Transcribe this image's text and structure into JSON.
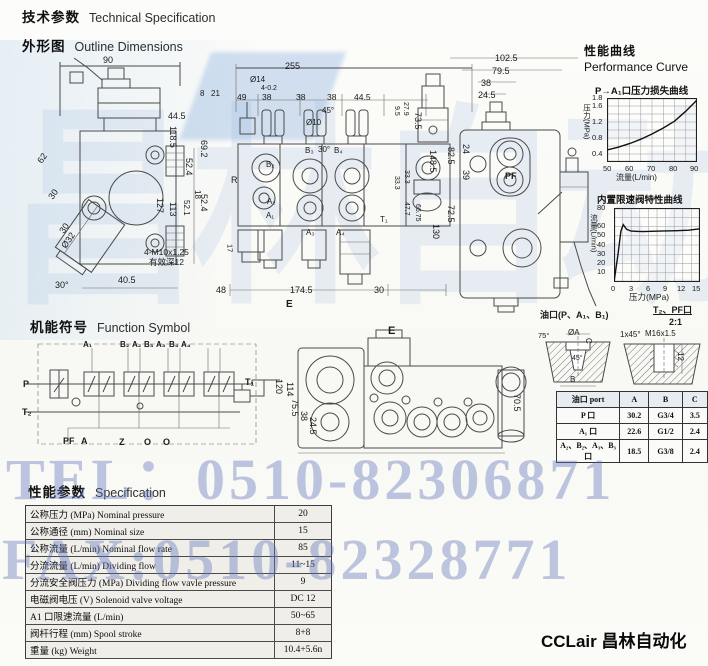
{
  "page": {
    "header_cn": "技术参数",
    "header_en": "Technical Specification",
    "outline_cn": "外形图",
    "outline_en": "Outline Dimensions",
    "function_cn": "机能符号",
    "function_en": "Function Symbol",
    "spec_cn": "性能参数",
    "spec_en": "Specification",
    "perf_cn": "性能曲线",
    "perf_en": "Performance Curve",
    "brand": "CCLair 昌林自动化"
  },
  "watermarks": {
    "tel": "TEL：0510-82306871",
    "fax": "FAX:0510-82328771",
    "big": "昌林自动化"
  },
  "colors": {
    "watermark_blue": "#5f73bc",
    "scan_tint": "#aacdeb",
    "line": "#4a4a4a",
    "table_row_bg": "#efeee9"
  },
  "chart_data": [
    {
      "type": "line",
      "title": "P→A₁口压力损失曲线",
      "xlabel": "流量(L/min)",
      "ylabel": "压力(MPa)",
      "x": [
        50,
        55,
        60,
        65,
        70,
        75,
        80,
        85,
        90
      ],
      "y": [
        0.5,
        0.57,
        0.66,
        0.77,
        0.9,
        1.05,
        1.22,
        1.47,
        1.75
      ],
      "xlim": [
        50,
        90
      ],
      "ylim": [
        0.2,
        1.8
      ],
      "xticks": [
        50,
        60,
        70,
        80,
        90
      ],
      "yticks": [
        0.4,
        0.8,
        1.2,
        1.6,
        1.8
      ],
      "grid_cols": 8,
      "grid_rows": 8,
      "grid": true,
      "legend": false
    },
    {
      "type": "line",
      "title": "内置限速阀特性曲线",
      "xlabel": "压力(MPa)",
      "ylabel": "流量(L/min)",
      "x": [
        0,
        0.7,
        1.2,
        1.6,
        2.2,
        3,
        5,
        8,
        11,
        13,
        15
      ],
      "y": [
        0,
        30,
        55,
        62,
        57,
        55,
        54.5,
        55,
        55.5,
        56,
        57.5
      ],
      "xlim": [
        0,
        15
      ],
      "ylim": [
        0,
        80
      ],
      "xticks": [
        0,
        3,
        6,
        9,
        12,
        15
      ],
      "yticks": [
        10,
        20,
        30,
        40,
        50,
        60,
        80
      ],
      "grid_cols": 10,
      "grid_rows": 8,
      "grid": true,
      "legend": false
    }
  ],
  "port_table": {
    "rows": [
      [
        "油口 port",
        "A",
        "B",
        "C"
      ],
      [
        "P 口",
        "30.2",
        "G3/4",
        "3.5"
      ],
      [
        "A₁ 口",
        "22.6",
        "G1/2",
        "2.4"
      ],
      [
        "A₂、B₂、A₃、B₃ 口",
        "18.5",
        "G3/8",
        "2.4"
      ]
    ]
  },
  "spec_table": {
    "rows": [
      [
        "公称压力 (MPa)  Nominal pressure",
        "20"
      ],
      [
        "公称通径 (mm)  Nominal size",
        "15"
      ],
      [
        "公称流量 (L/min)  Nominal flow rate",
        "85"
      ],
      [
        "分流流量 (L/min)  Dividing flow",
        "11~15"
      ],
      [
        "分流安全阀压力 (MPa)  Dividing flow vavle pressure",
        "9"
      ],
      [
        "电磁阀电压 (V)  Solenoid valve voltage",
        "DC 12"
      ],
      [
        "A1 口限速流量 (L/min)",
        "50~65"
      ],
      [
        "阀杆行程 (mm)  Spool stroke",
        "8+8"
      ],
      [
        "重量 (kg)  Weight",
        "10.4+5.6n"
      ]
    ]
  },
  "labels": [
    {
      "t": "90",
      "x": 103,
      "y": 56
    },
    {
      "t": "44.5",
      "x": 168,
      "y": 112
    },
    {
      "t": "69.2",
      "x": 199,
      "y": 140,
      "v": 1
    },
    {
      "t": "52.4",
      "x": 199,
      "y": 194,
      "v": 1
    },
    {
      "t": "62",
      "x": 36,
      "y": 160,
      "r": -55
    },
    {
      "t": "30",
      "x": 47,
      "y": 196,
      "r": -55
    },
    {
      "t": "30",
      "x": 58,
      "y": 230,
      "r": -55
    },
    {
      "t": "Ø32",
      "x": 60,
      "y": 245,
      "r": -55
    },
    {
      "t": "30°",
      "x": 55,
      "y": 281
    },
    {
      "t": "40.5",
      "x": 118,
      "y": 276
    },
    {
      "t": "8",
      "x": 200,
      "y": 90,
      "s": 8
    },
    {
      "t": "21",
      "x": 211,
      "y": 90,
      "s": 8
    },
    {
      "t": "118.5",
      "x": 168,
      "y": 126,
      "v": 1
    },
    {
      "t": "52.4",
      "x": 184,
      "y": 158,
      "v": 1
    },
    {
      "t": "18",
      "x": 193,
      "y": 190,
      "v": 1,
      "s": 8
    },
    {
      "t": "52.1",
      "x": 182,
      "y": 200,
      "v": 1,
      "s": 8
    },
    {
      "t": "127",
      "x": 155,
      "y": 198,
      "v": 1
    },
    {
      "t": "113",
      "x": 168,
      "y": 202,
      "v": 1
    },
    {
      "t": "17",
      "x": 226,
      "y": 244,
      "v": 1,
      "s": 7.5
    },
    {
      "t": "4-M10x1.25",
      "x": 144,
      "y": 248,
      "s": 8.5
    },
    {
      "t": "有效深12",
      "x": 149,
      "y": 258,
      "s": 8.5
    },
    {
      "t": "255",
      "x": 285,
      "y": 62
    },
    {
      "t": "Ø14",
      "x": 250,
      "y": 76,
      "s": 8
    },
    {
      "t": "4-0.2",
      "x": 261,
      "y": 85,
      "s": 7
    },
    {
      "t": "49",
      "x": 237,
      "y": 93,
      "s": 8.5
    },
    {
      "t": "38",
      "x": 262,
      "y": 93,
      "s": 8.5
    },
    {
      "t": "38",
      "x": 296,
      "y": 93,
      "s": 8.5
    },
    {
      "t": "38",
      "x": 327,
      "y": 93,
      "s": 8.5
    },
    {
      "t": "44.5",
      "x": 354,
      "y": 93,
      "s": 8.5
    },
    {
      "t": "45°",
      "x": 322,
      "y": 107,
      "s": 8
    },
    {
      "t": "Ø10",
      "x": 306,
      "y": 119,
      "s": 8
    },
    {
      "t": "30°",
      "x": 318,
      "y": 146,
      "s": 8
    },
    {
      "t": "R",
      "x": 231,
      "y": 176
    },
    {
      "t": "B₂",
      "x": 266,
      "y": 161,
      "s": 8
    },
    {
      "t": "B₃",
      "x": 305,
      "y": 147,
      "s": 8
    },
    {
      "t": "B₄",
      "x": 334,
      "y": 147,
      "s": 8
    },
    {
      "t": "A₂",
      "x": 267,
      "y": 198,
      "s": 8
    },
    {
      "t": "A₁",
      "x": 266,
      "y": 212,
      "s": 8
    },
    {
      "t": "A₃",
      "x": 306,
      "y": 229,
      "s": 8
    },
    {
      "t": "A₄",
      "x": 336,
      "y": 229,
      "s": 8
    },
    {
      "t": "T₁",
      "x": 380,
      "y": 216,
      "s": 8
    },
    {
      "t": "9.5",
      "x": 393,
      "y": 106,
      "v": 1,
      "s": 7
    },
    {
      "t": "27.9",
      "x": 402,
      "y": 102,
      "v": 1,
      "s": 7
    },
    {
      "t": "73.5",
      "x": 413,
      "y": 112,
      "v": 1
    },
    {
      "t": "148.5",
      "x": 428,
      "y": 150,
      "v": 1
    },
    {
      "t": "33.3",
      "x": 393,
      "y": 176,
      "v": 1,
      "s": 7
    },
    {
      "t": "33.3",
      "x": 403,
      "y": 170,
      "v": 1,
      "s": 7
    },
    {
      "t": "47.7",
      "x": 403,
      "y": 202,
      "v": 1,
      "s": 7
    },
    {
      "t": "66.75",
      "x": 414,
      "y": 204,
      "v": 1,
      "s": 7
    },
    {
      "t": "130",
      "x": 431,
      "y": 224,
      "v": 1
    },
    {
      "t": "48",
      "x": 216,
      "y": 286
    },
    {
      "t": "174.5",
      "x": 290,
      "y": 286
    },
    {
      "t": "30",
      "x": 374,
      "y": 286
    },
    {
      "t": "E",
      "x": 286,
      "y": 300,
      "b": 1,
      "s": 10
    },
    {
      "t": "102.5",
      "x": 495,
      "y": 54
    },
    {
      "t": "79.5",
      "x": 492,
      "y": 67
    },
    {
      "t": "38",
      "x": 481,
      "y": 79
    },
    {
      "t": "24.5",
      "x": 478,
      "y": 91
    },
    {
      "t": "82.5",
      "x": 446,
      "y": 147,
      "v": 1
    },
    {
      "t": "24",
      "x": 461,
      "y": 144,
      "v": 1
    },
    {
      "t": "39",
      "x": 461,
      "y": 170,
      "v": 1
    },
    {
      "t": "72.5",
      "x": 446,
      "y": 205,
      "v": 1
    },
    {
      "t": "PF",
      "x": 505,
      "y": 172,
      "b": 1
    },
    {
      "t": "E",
      "x": 388,
      "y": 326,
      "b": 1,
      "s": 11
    },
    {
      "t": "120",
      "x": 274,
      "y": 379,
      "v": 1
    },
    {
      "t": "114",
      "x": 285,
      "y": 382,
      "v": 1
    },
    {
      "t": "75.5",
      "x": 290,
      "y": 399,
      "v": 1
    },
    {
      "t": "38",
      "x": 299,
      "y": 411,
      "v": 1
    },
    {
      "t": "24.5",
      "x": 308,
      "y": 417,
      "v": 1
    },
    {
      "t": "70.5",
      "x": 512,
      "y": 394,
      "v": 1
    },
    {
      "t": "A₁",
      "x": 83,
      "y": 341,
      "s": 8,
      "b": 1
    },
    {
      "t": "B₂",
      "x": 120,
      "y": 341,
      "s": 8,
      "b": 1
    },
    {
      "t": "A₂",
      "x": 132,
      "y": 341,
      "s": 8,
      "b": 1
    },
    {
      "t": "B₃",
      "x": 144,
      "y": 341,
      "s": 8,
      "b": 1
    },
    {
      "t": "A₃",
      "x": 156,
      "y": 341,
      "s": 8,
      "b": 1
    },
    {
      "t": "B₄",
      "x": 169,
      "y": 341,
      "s": 8,
      "b": 1
    },
    {
      "t": "A₄",
      "x": 181,
      "y": 341,
      "s": 8,
      "b": 1
    },
    {
      "t": "P",
      "x": 23,
      "y": 380,
      "b": 1
    },
    {
      "t": "T₁",
      "x": 245,
      "y": 378,
      "b": 1
    },
    {
      "t": "T₂",
      "x": 22,
      "y": 408,
      "b": 1
    },
    {
      "t": "PF",
      "x": 63,
      "y": 437,
      "b": 1
    },
    {
      "t": "A",
      "x": 81,
      "y": 437,
      "b": 1
    },
    {
      "t": "Z",
      "x": 119,
      "y": 438,
      "b": 1
    },
    {
      "t": "O",
      "x": 144,
      "y": 438,
      "b": 1
    },
    {
      "t": "O",
      "x": 163,
      "y": 438,
      "b": 1
    },
    {
      "t": "油口(P、A₁、B₁)",
      "x": 540,
      "y": 311,
      "s": 9,
      "b": 1
    },
    {
      "t": "T₂、PF口",
      "x": 653,
      "y": 306,
      "s": 9,
      "b": 1,
      "u": 1
    },
    {
      "t": "2:1",
      "x": 669,
      "y": 318,
      "s": 9,
      "b": 1
    },
    {
      "t": "75°",
      "x": 538,
      "y": 332,
      "s": 7.5
    },
    {
      "t": "ØA",
      "x": 568,
      "y": 329,
      "s": 8
    },
    {
      "t": "C",
      "x": 584,
      "y": 338,
      "v": 1,
      "s": 8
    },
    {
      "t": "45°",
      "x": 572,
      "y": 355,
      "s": 7
    },
    {
      "t": "B",
      "x": 570,
      "y": 376,
      "s": 8
    },
    {
      "t": "1x45°",
      "x": 620,
      "y": 331,
      "s": 8
    },
    {
      "t": "M16x1.5",
      "x": 645,
      "y": 330,
      "s": 8
    },
    {
      "t": "12",
      "x": 676,
      "y": 352,
      "v": 1,
      "s": 8
    },
    {
      "t": "1.8",
      "x": 592,
      "y": 94,
      "s": 7.5
    },
    {
      "t": "1.6",
      "x": 592,
      "y": 102,
      "s": 7.5
    },
    {
      "t": "1.2",
      "x": 592,
      "y": 118,
      "s": 7.5
    },
    {
      "t": "0.8",
      "x": 592,
      "y": 134,
      "s": 7.5
    },
    {
      "t": "0.4",
      "x": 592,
      "y": 150,
      "s": 7.5
    },
    {
      "t": "50",
      "x": 603,
      "y": 165,
      "s": 7.5
    },
    {
      "t": "60",
      "x": 625,
      "y": 165,
      "s": 7.5
    },
    {
      "t": "70",
      "x": 647,
      "y": 165,
      "s": 7.5
    },
    {
      "t": "80",
      "x": 669,
      "y": 165,
      "s": 7.5
    },
    {
      "t": "90",
      "x": 690,
      "y": 165,
      "s": 7.5
    },
    {
      "t": "压力(MPa)",
      "x": 583,
      "y": 104,
      "v": 1,
      "s": 7.5
    },
    {
      "t": "流量(L/min)",
      "x": 616,
      "y": 174,
      "s": 8
    },
    {
      "t": "80",
      "x": 597,
      "y": 204,
      "s": 7.5
    },
    {
      "t": "60",
      "x": 597,
      "y": 222,
      "s": 7.5
    },
    {
      "t": "50",
      "x": 597,
      "y": 231,
      "s": 7.5
    },
    {
      "t": "40",
      "x": 597,
      "y": 241,
      "s": 7.5
    },
    {
      "t": "30",
      "x": 597,
      "y": 250,
      "s": 7.5
    },
    {
      "t": "20",
      "x": 597,
      "y": 259,
      "s": 7.5
    },
    {
      "t": "10",
      "x": 597,
      "y": 268,
      "s": 7.5
    },
    {
      "t": "0",
      "x": 611,
      "y": 285,
      "s": 7.5
    },
    {
      "t": "3",
      "x": 629,
      "y": 285,
      "s": 7.5
    },
    {
      "t": "6",
      "x": 646,
      "y": 285,
      "s": 7.5
    },
    {
      "t": "9",
      "x": 663,
      "y": 285,
      "s": 7.5
    },
    {
      "t": "12",
      "x": 677,
      "y": 285,
      "s": 7.5
    },
    {
      "t": "15",
      "x": 692,
      "y": 285,
      "s": 7.5
    },
    {
      "t": "流量(L/min)",
      "x": 590,
      "y": 214,
      "v": 1,
      "s": 7.5
    },
    {
      "t": "压力(MPa)",
      "x": 629,
      "y": 293,
      "s": 8.5
    }
  ]
}
